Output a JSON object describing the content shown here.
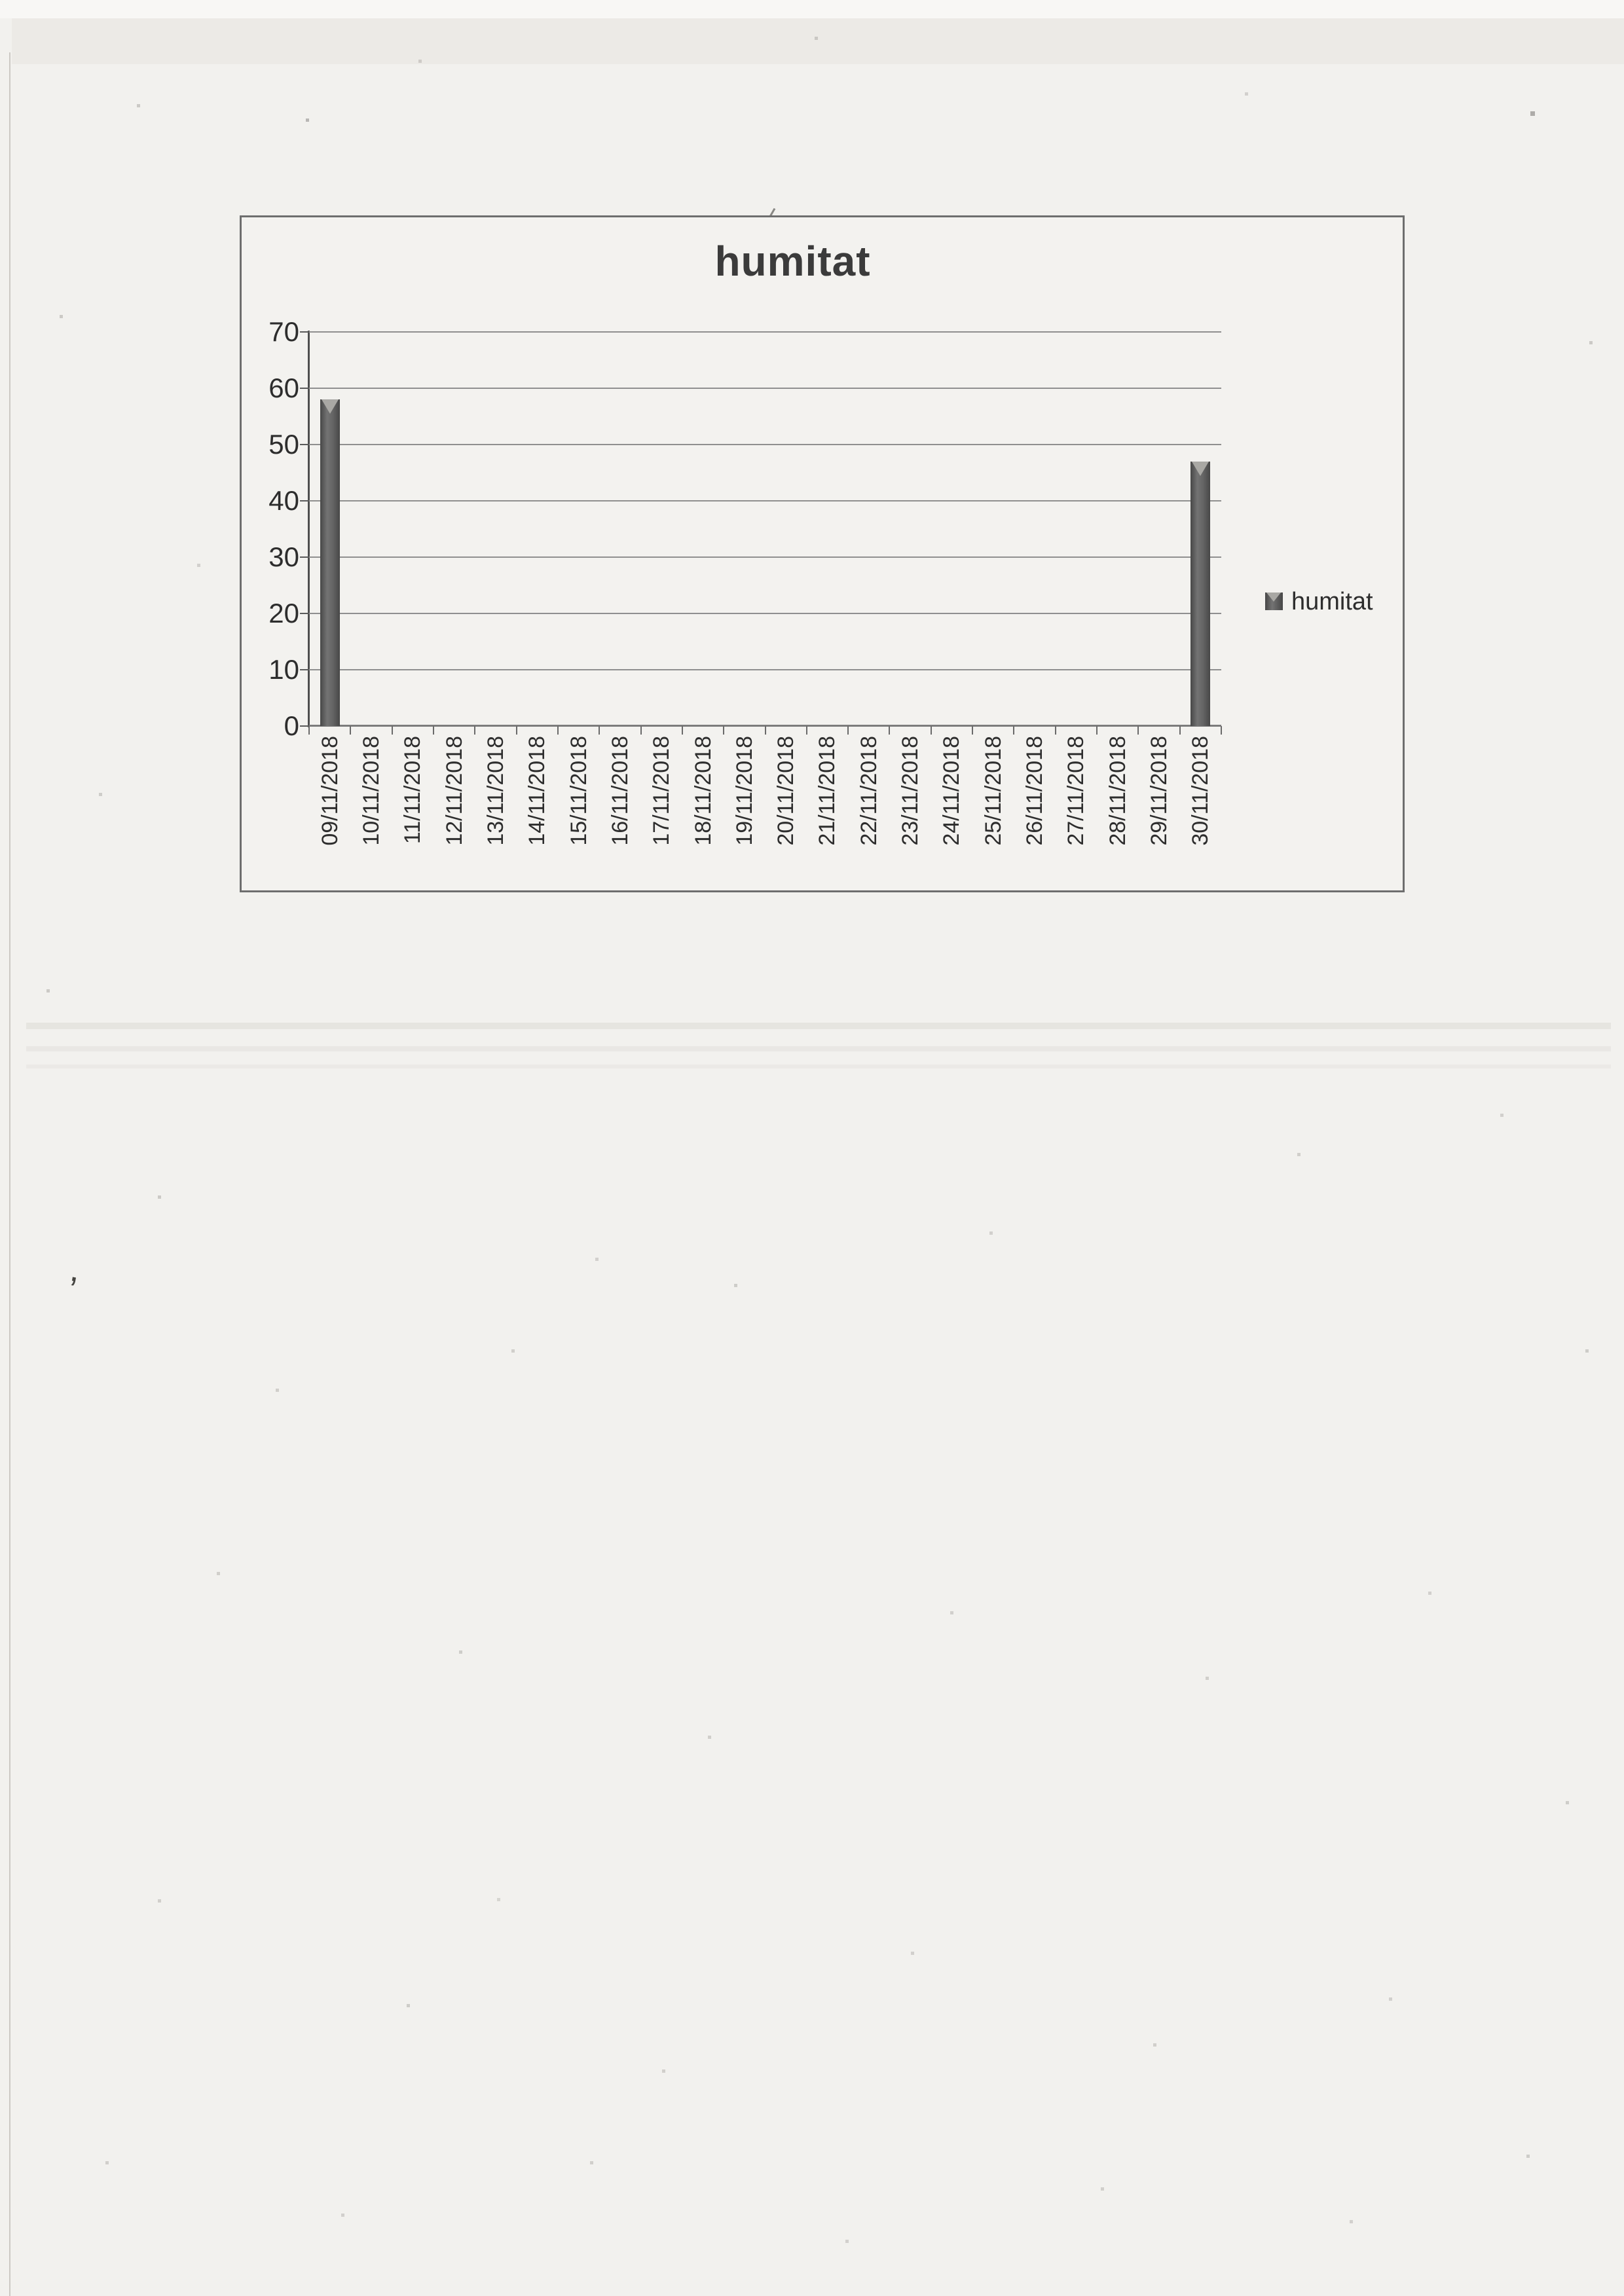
{
  "chart_data": {
    "type": "bar",
    "title": "humitat",
    "categories": [
      "09/11/2018",
      "10/11/2018",
      "11/11/2018",
      "12/11/2018",
      "13/11/2018",
      "14/11/2018",
      "15/11/2018",
      "16/11/2018",
      "17/11/2018",
      "18/11/2018",
      "19/11/2018",
      "20/11/2018",
      "21/11/2018",
      "22/11/2018",
      "23/11/2018",
      "24/11/2018",
      "25/11/2018",
      "26/11/2018",
      "27/11/2018",
      "28/11/2018",
      "29/11/2018",
      "30/11/2018"
    ],
    "values": [
      58,
      0,
      0,
      0,
      0,
      0,
      0,
      0,
      0,
      0,
      0,
      0,
      0,
      0,
      0,
      0,
      0,
      0,
      0,
      0,
      0,
      47
    ],
    "series": [
      {
        "name": "humitat",
        "values": [
          58,
          0,
          0,
          0,
          0,
          0,
          0,
          0,
          0,
          0,
          0,
          0,
          0,
          0,
          0,
          0,
          0,
          0,
          0,
          0,
          0,
          47
        ]
      }
    ],
    "xlabel": "",
    "ylabel": "",
    "ylim": [
      0,
      70
    ],
    "yticks": [
      0,
      10,
      20,
      30,
      40,
      50,
      60,
      70
    ],
    "grid": true,
    "legend": {
      "label": "humitat",
      "position": "right"
    },
    "colors": {
      "bar": "#5b5b5b",
      "bar_edge_dark": "#474747",
      "bar_bevel": "#a9a8a4",
      "gridline": "#8f8f8f",
      "axis": "#4f4f4f",
      "tick_text": "#2d2d2d",
      "title_text": "#3b3b3b",
      "frame_border": "#6e6e6e",
      "paper": "#f2f1ee"
    }
  }
}
